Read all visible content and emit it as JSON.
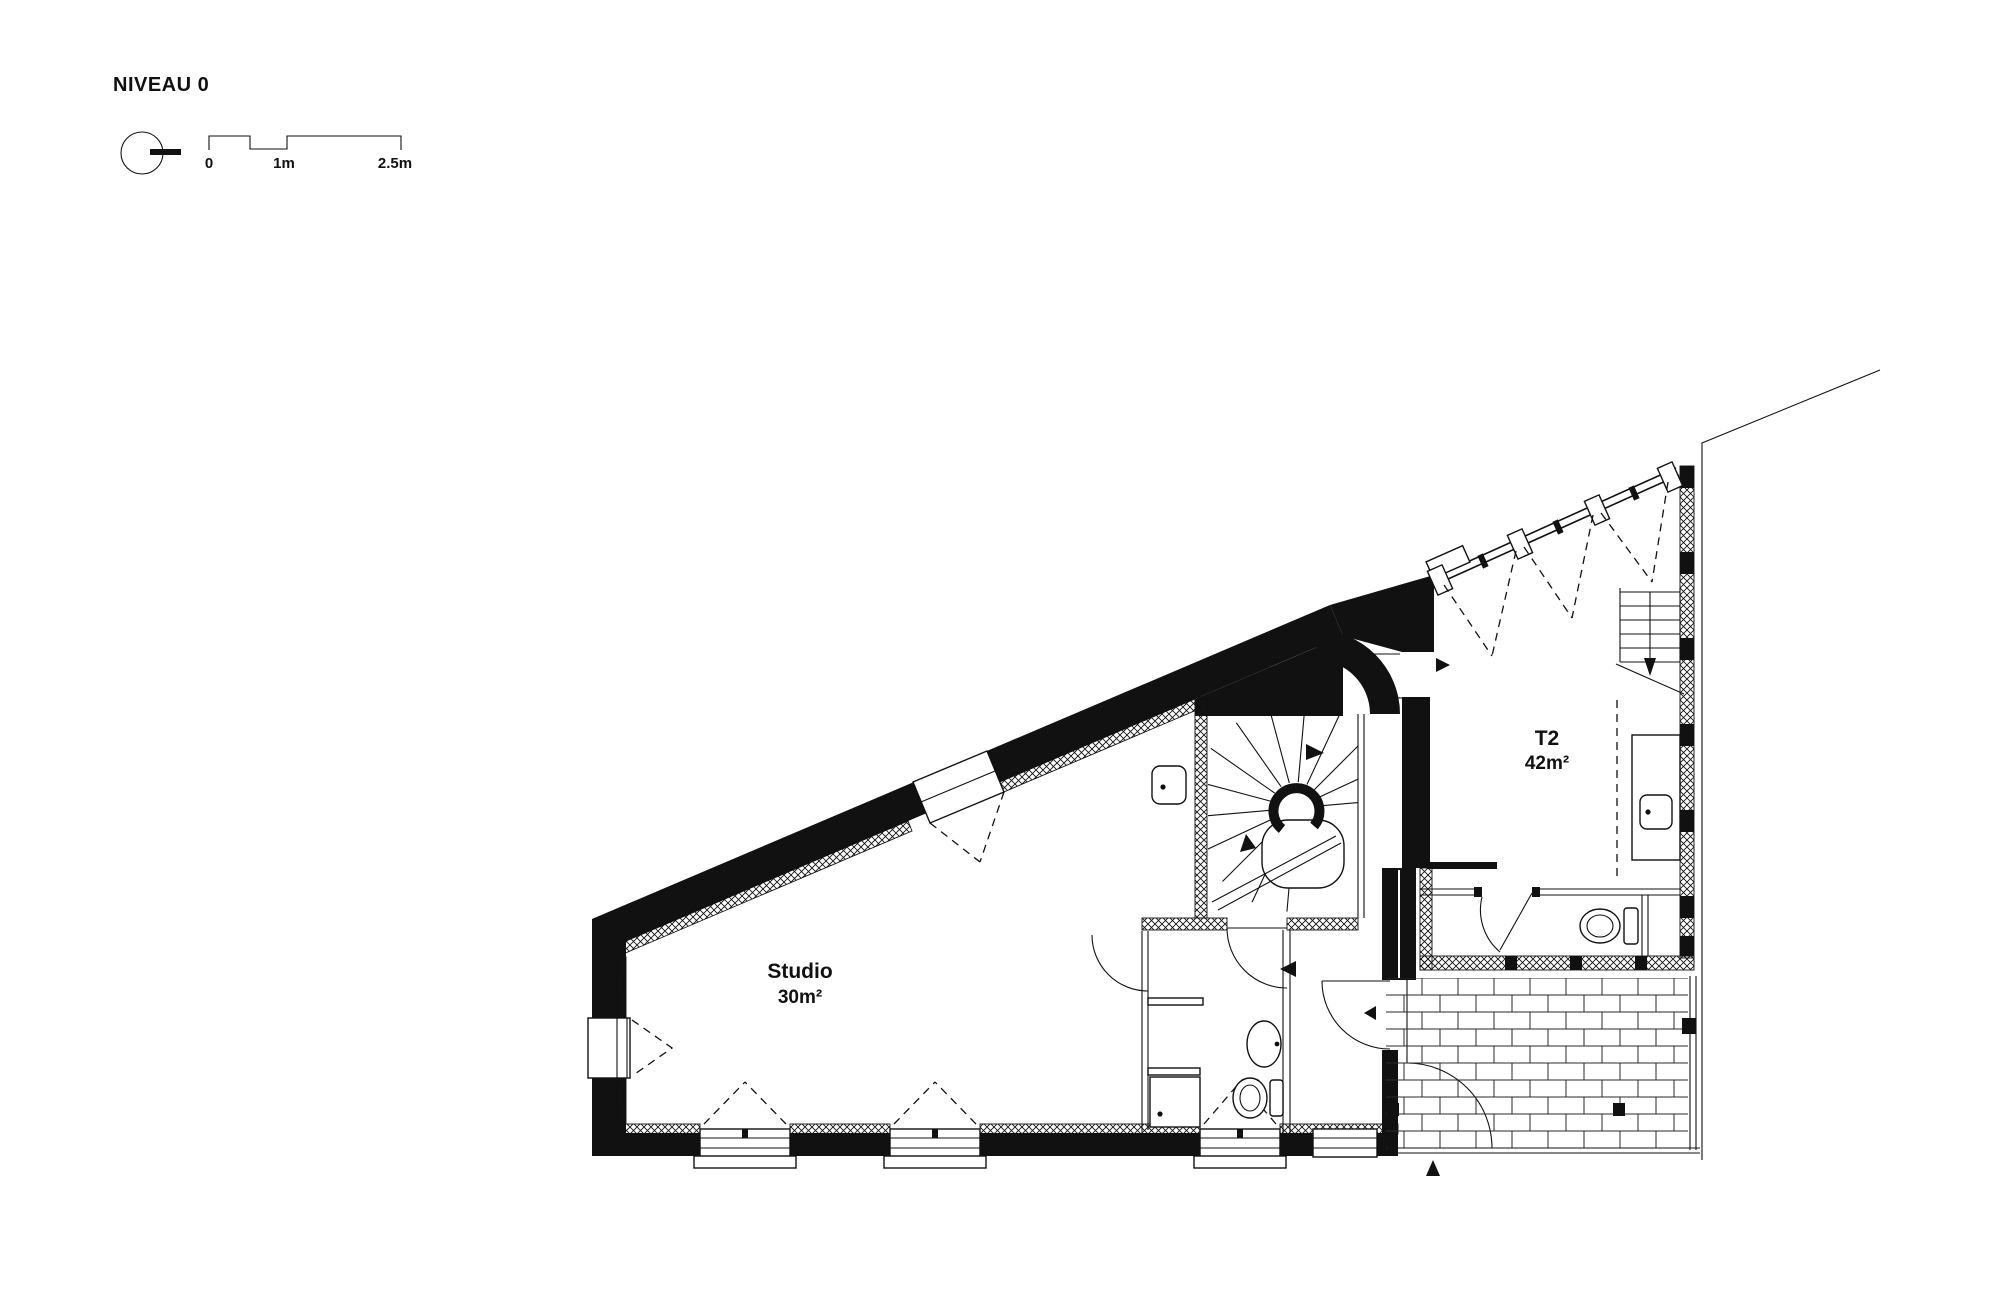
{
  "drawing": {
    "title": "NIVEAU 0",
    "scale_bar": {
      "tick0": "0",
      "tick1": "1m",
      "tick2": "2.5m"
    },
    "rooms": {
      "studio": {
        "name": "Studio",
        "area": "30m²"
      },
      "t2": {
        "name": "T2",
        "area": "42m²"
      }
    },
    "symbols": {
      "level_marker": "circle-with-tick",
      "stair_direction": "up-arrow",
      "entrance_marker": "solid-triangle"
    },
    "colors": {
      "ink": "#111111",
      "paper": "#ffffff",
      "brick_line": "#2a2a2a"
    }
  }
}
